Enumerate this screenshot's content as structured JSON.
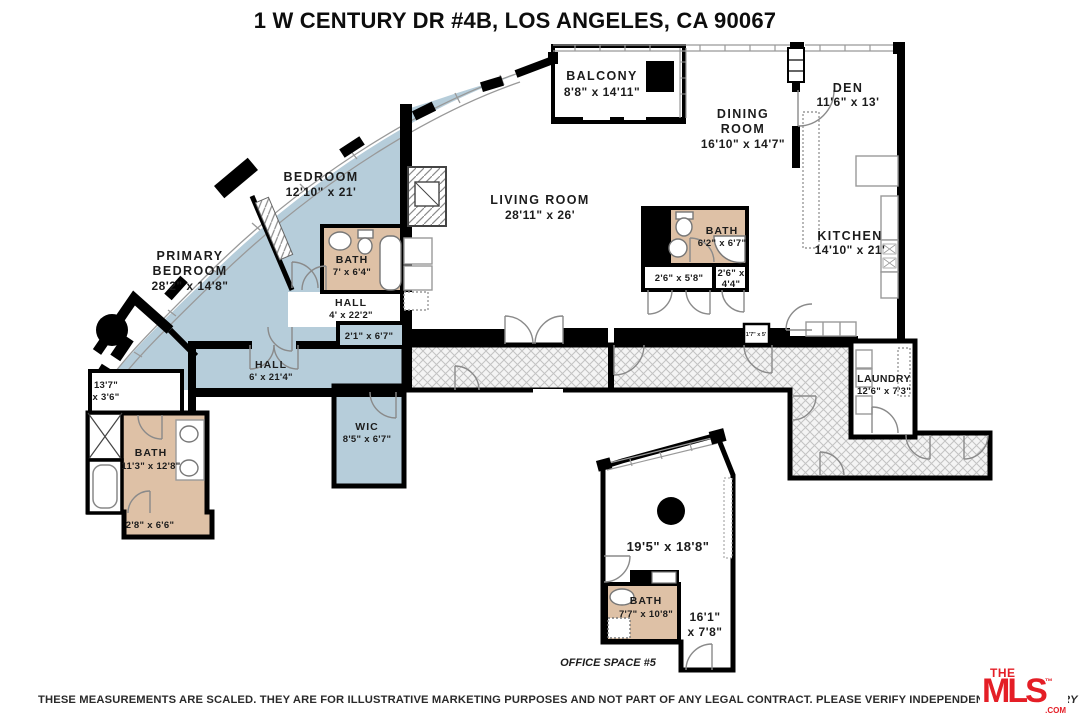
{
  "title": "1 W CENTURY DR #4B, LOS ANGELES, CA 90067",
  "labels": {
    "balcony_name": "BALCONY",
    "balcony_dims": "8'8\" x 14'11\"",
    "dining_1": "DINING",
    "dining_2": "ROOM",
    "dining_dims": "16'10\" x 14'7\"",
    "den_name": "DEN",
    "den_dims": "11'6\" x 13'",
    "living_name": "LIVING ROOM",
    "living_dims": "28'11\" x 26'",
    "kitchen_name": "KITCHEN",
    "kitchen_dims": "14'10\" x 21'",
    "bedroom_name": "BEDROOM",
    "bedroom_dims": "12'10\" x 21'",
    "primary_1": "PRIMARY",
    "primary_2": "BEDROOM",
    "primary_dims": "28'2\" x 14'8\"",
    "bath_upper_name": "BATH",
    "bath_upper_dims": "7' x 6'4\"",
    "hall_upper_name": "HALL",
    "hall_upper_dims": "4' x 22'2\"",
    "closet_21_dims": "2'1\" x 6'7\"",
    "hall_lower_name": "HALL",
    "hall_lower_dims": "6' x 21'4\"",
    "wic_name": "WIC",
    "wic_dims": "8'5\" x 6'7\"",
    "closet_137_1": "13'7\"",
    "closet_137_2": "x 3'6\"",
    "bath_lower_name": "BATH",
    "bath_lower_dims": "11'3\" x 12'8\"",
    "closet_28_dims": "2'8\" x 6'6\"",
    "bath_center_name": "BATH",
    "bath_center_dims": "6'2\" x 6'7\"",
    "closet_26a_dims": "2'6\" x 5'8\"",
    "closet_26b_1": "2'6\" x",
    "closet_26b_2": "4'4\"",
    "laundry_name": "LAUNDRY",
    "laundry_dims": "12'6\" x 7'3\"",
    "closet_tiny_dims": "1'7\" x 5'",
    "office_main_dims": "19'5\" x 18'8\"",
    "office_bath_name": "BATH",
    "office_bath_dims": "7'7\" x 10'8\"",
    "office_side_1": "16'1\"",
    "office_side_2": "x 7'8\"",
    "office_label": "OFFICE SPACE #5"
  },
  "footer": {
    "disclaimer": "THESE MEASUREMENTS ARE SCALED.  THEY ARE FOR ILLUSTRATIVE MARKETING PURPOSES AND NOT PART OF ANY LEGAL CONTRACT.  PLEASE VERIFY INDEPENDENTLY.",
    "copyright": "© HILLARY CAMPBELL"
  },
  "logo": {
    "the": "THE",
    "mls": "MLS",
    "com": ".COM",
    "tm": "™"
  },
  "colors": {
    "room_blue": "#b6cdda",
    "bath_tan": "#dec1a6",
    "wall": "#000000",
    "logo_red": "#e41e26"
  }
}
